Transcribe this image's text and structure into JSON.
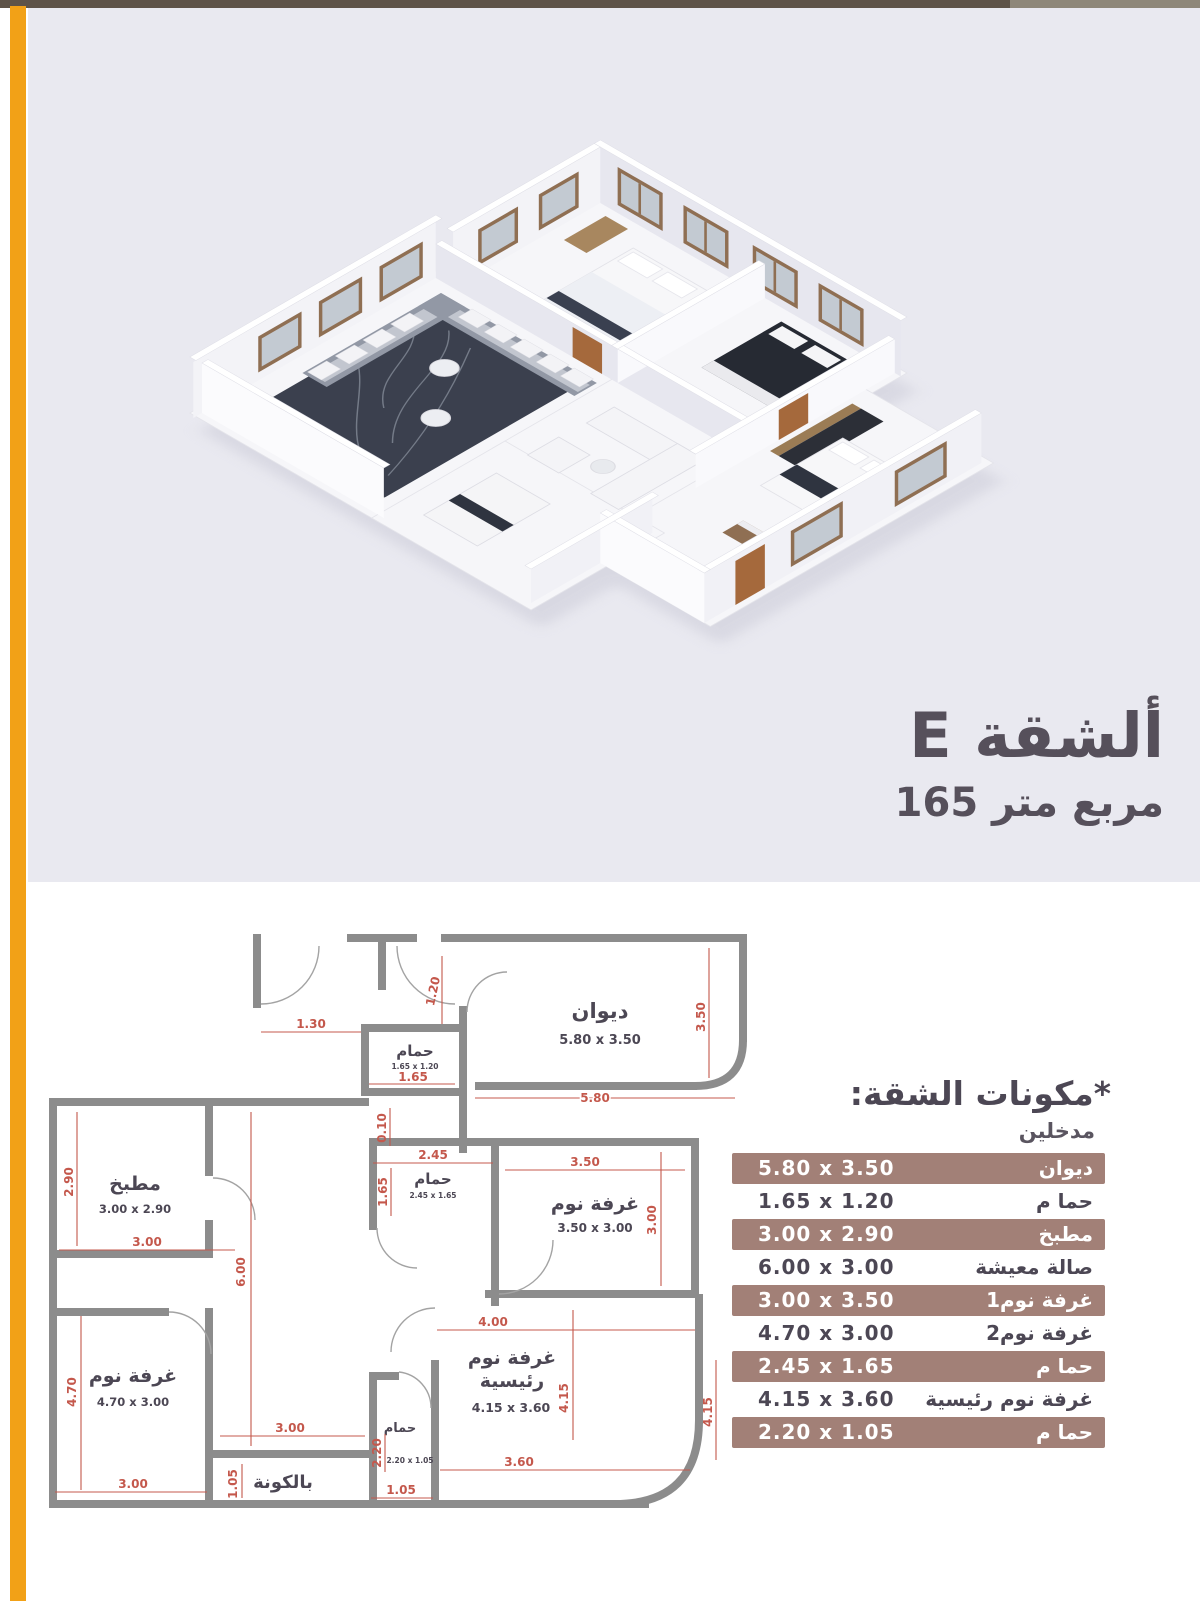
{
  "colors": {
    "accent_orange": "#F2A117",
    "top_bar": "#5E5348",
    "render_background": "#E9E9F0",
    "title_text": "#56505B",
    "table_highlight": "#A28077",
    "dimension_red": "#C4584C",
    "wall_gray": "#8C8C8C"
  },
  "header": {
    "title": "ألشقة E",
    "area": "مربع متر 165"
  },
  "table": {
    "heading": "*مكونات الشقة:",
    "subheading": "مدخلين",
    "rows": [
      {
        "name": "ديوان",
        "dims": "5.80 x 3.50",
        "highlighted": true
      },
      {
        "name": "حما م",
        "dims": "1.65 x 1.20",
        "highlighted": false
      },
      {
        "name": "مطبخ",
        "dims": "3.00 x 2.90",
        "highlighted": true
      },
      {
        "name": "صالة معيشة",
        "dims": "6.00 x 3.00",
        "highlighted": false
      },
      {
        "name": "غرفة نوم1",
        "dims": "3.00 x 3.50",
        "highlighted": true
      },
      {
        "name": "غرفة نوم2",
        "dims": "4.70 x 3.00",
        "highlighted": false
      },
      {
        "name": "حما م",
        "dims": "2.45 x 1.65",
        "highlighted": true
      },
      {
        "name": "غرفة نوم رئيسية",
        "dims": "4.15 x 3.60",
        "highlighted": false
      },
      {
        "name": "حما م",
        "dims": "2.20 x 1.05",
        "highlighted": true
      }
    ]
  },
  "plan": {
    "labels": {
      "diwan": "ديوان",
      "diwan_dims": "5.80 x 3.50",
      "bath_top": "حمام",
      "bath_top_dims": "1.65 x 1.20",
      "kitchen": "مطبخ",
      "kitchen_dims": "3.00 x 2.90",
      "bath_mid": "حمام",
      "bath_mid_dims": "2.45 x 1.65",
      "bed1": "غرفة نوم",
      "bed1_dims": "3.50 x 3.00",
      "bed2": "غرفة نوم",
      "bed2_dims": "4.70 x 3.00",
      "master_l1": "غرفة نوم",
      "master_l2": "رئيسية",
      "master_dims": "4.15 x 3.60",
      "bath_bottom": "حمام",
      "bath_bottom_dims": "2.20 x 1.05",
      "balcony": "بالكونة"
    },
    "dims": {
      "d130": "1.30",
      "d120": "1.20",
      "d165": "1.65",
      "d580": "5.80",
      "d350r": "3.50",
      "d010": "0.10",
      "d245": "2.45",
      "d165v": "1.65",
      "d350": "3.50",
      "d300r": "3.00",
      "d290": "2.90",
      "d300k": "3.00",
      "d600": "6.00",
      "d400": "4.00",
      "d415": "4.15",
      "d415r": "4.15",
      "d360": "3.60",
      "d470": "4.70",
      "d300b": "3.00",
      "d300bal": "3.00",
      "d105v": "1.05",
      "d220": "2.20",
      "d105": "1.05"
    }
  }
}
